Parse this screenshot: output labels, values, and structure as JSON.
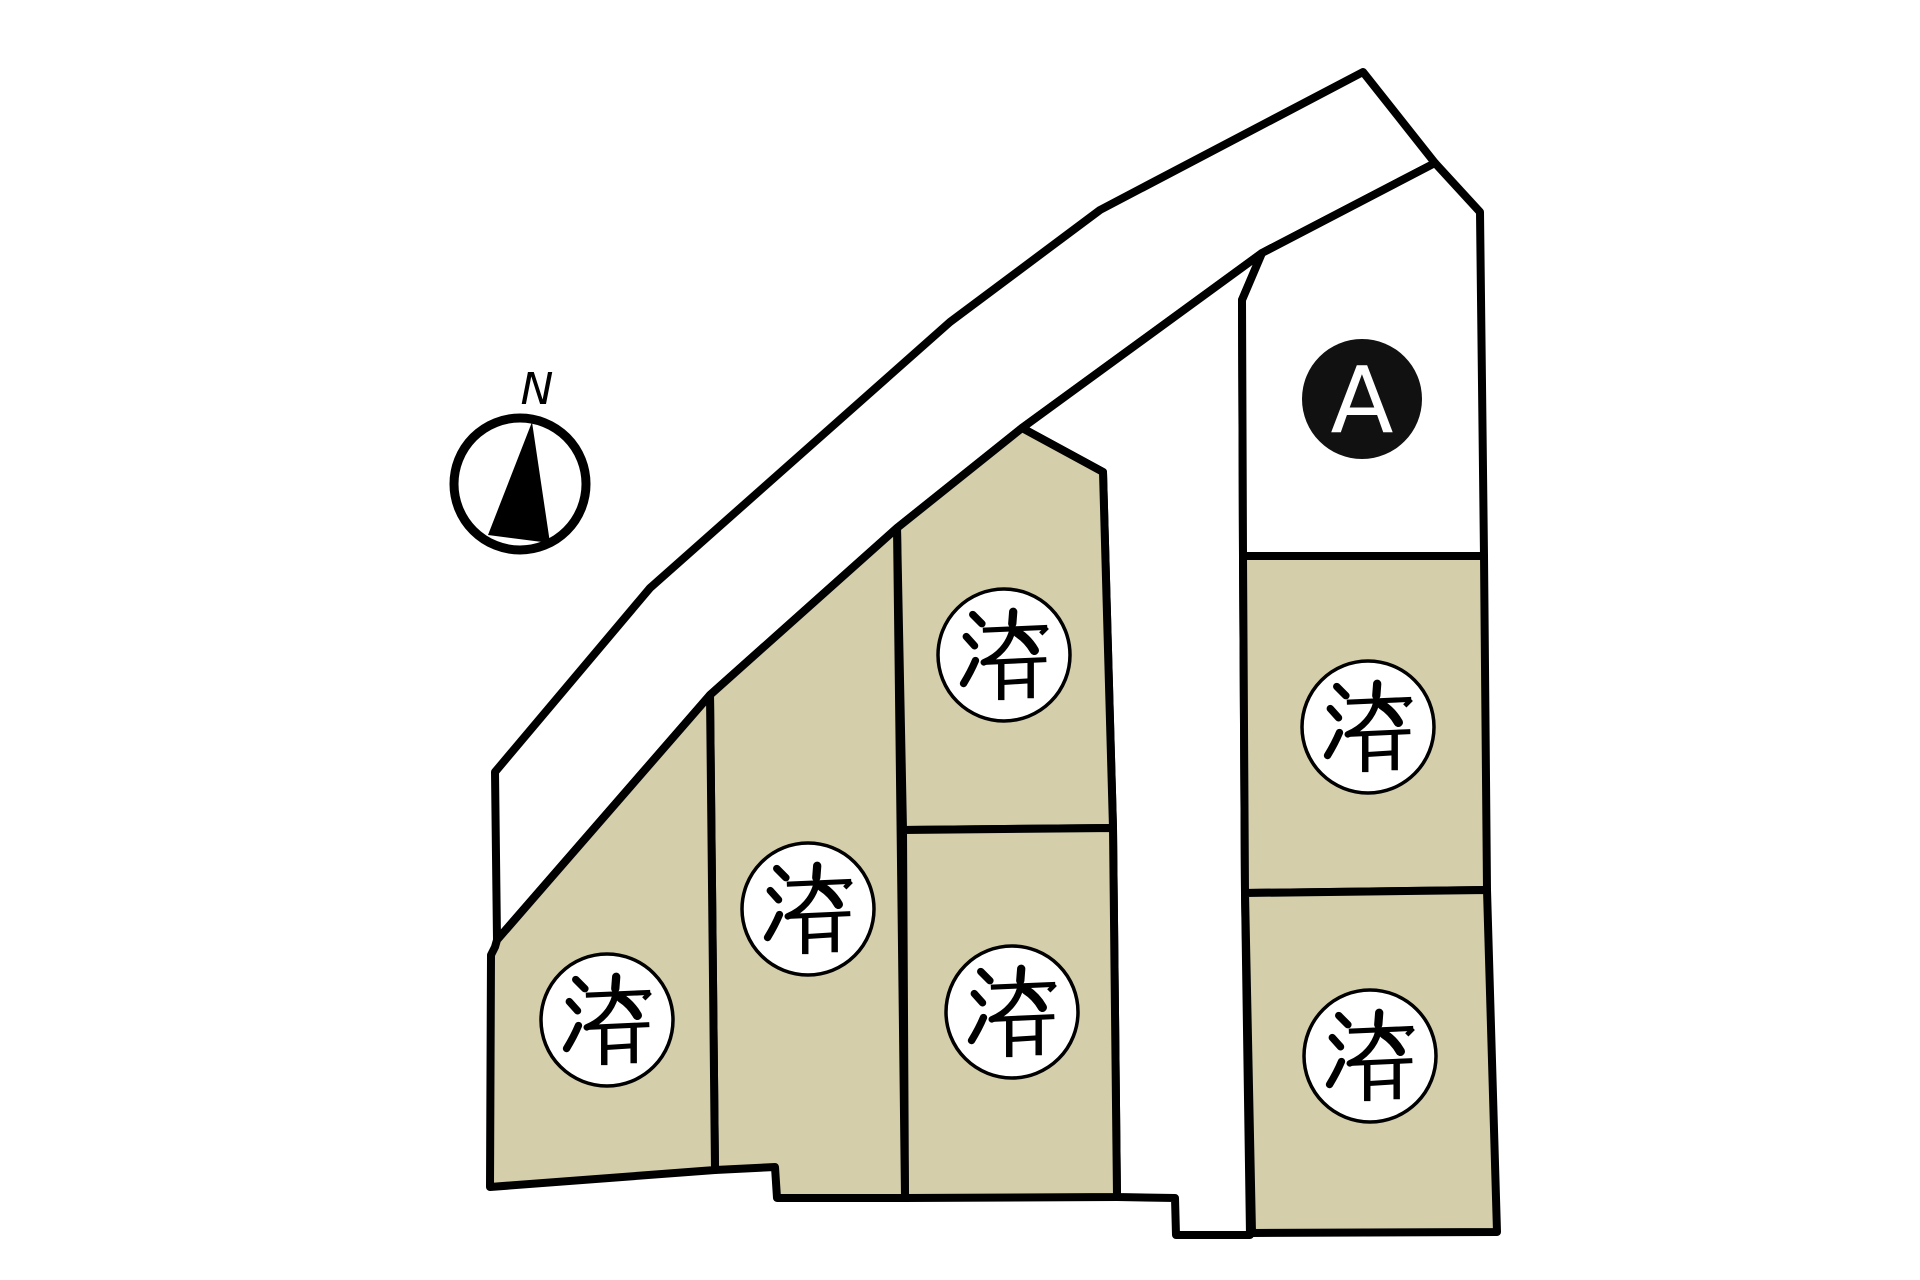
{
  "canvas": {
    "width": 1920,
    "height": 1280,
    "background": "#ffffff"
  },
  "colors": {
    "outline": "#000000",
    "sold_fill": "#d4cfaa",
    "road_fill": "#ffffff",
    "available_fill": "#ffffff",
    "sold_marker_fill": "#ffffff",
    "sold_marker_text": "#000000",
    "available_marker_fill": "#111111",
    "available_marker_text": "#ffffff"
  },
  "compass": {
    "label": "N"
  },
  "lots": [
    {
      "id": "lot-a",
      "status": "available",
      "marker_label": "A"
    },
    {
      "id": "lot-right-upper",
      "status": "sold",
      "marker_label": "済"
    },
    {
      "id": "lot-right-lower",
      "status": "sold",
      "marker_label": "済"
    },
    {
      "id": "lot-mid-upper",
      "status": "sold",
      "marker_label": "済"
    },
    {
      "id": "lot-mid-lower",
      "status": "sold",
      "marker_label": "済"
    },
    {
      "id": "lot-left-upper",
      "status": "sold",
      "marker_label": "済"
    },
    {
      "id": "lot-left-lower",
      "status": "sold",
      "marker_label": "済"
    }
  ]
}
